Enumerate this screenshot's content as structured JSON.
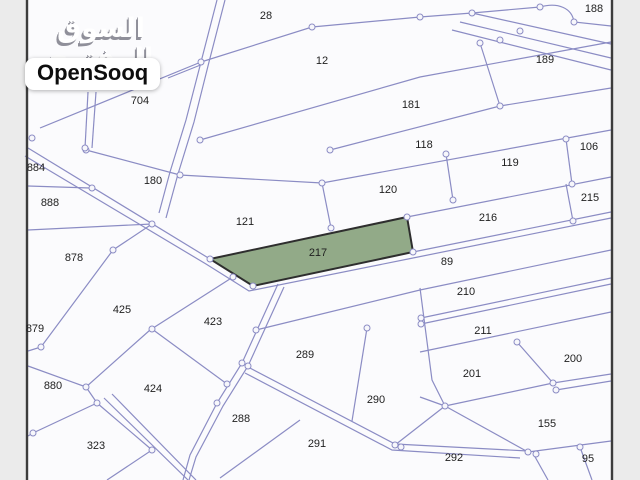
{
  "branding": {
    "arabic_logo": "السوق المفتوح",
    "latin_logo": "OpenSooq"
  },
  "map": {
    "type": "cadastral-parcel-map",
    "highlighted_parcel": {
      "number": "217",
      "fill": "#92aa88",
      "polygon": "210,259 407,217 413,252 253,286"
    },
    "colors": {
      "parcel_line": "#8b8cc4",
      "map_border": "#3c3c3c",
      "map_background": "#fbfbfd",
      "margin": "#ebebeb",
      "label_text": "#1f1f1f",
      "highlight_green": "#92aa88"
    },
    "parcels": [
      {
        "number": "28",
        "x": 266,
        "y": 16
      },
      {
        "number": "12",
        "x": 322,
        "y": 61
      },
      {
        "number": "188",
        "x": 594,
        "y": 9
      },
      {
        "number": "189",
        "x": 545,
        "y": 60
      },
      {
        "number": "704",
        "x": 140,
        "y": 101
      },
      {
        "number": "181",
        "x": 411,
        "y": 105
      },
      {
        "number": "118",
        "x": 424,
        "y": 145
      },
      {
        "number": "106",
        "x": 589,
        "y": 147
      },
      {
        "number": "119",
        "x": 510,
        "y": 163
      },
      {
        "number": "884",
        "x": 36,
        "y": 168
      },
      {
        "number": "180",
        "x": 153,
        "y": 181
      },
      {
        "number": "120",
        "x": 388,
        "y": 190
      },
      {
        "number": "215",
        "x": 590,
        "y": 198
      },
      {
        "number": "888",
        "x": 50,
        "y": 203
      },
      {
        "number": "216",
        "x": 488,
        "y": 218
      },
      {
        "number": "121",
        "x": 245,
        "y": 222
      },
      {
        "number": "217",
        "x": 318,
        "y": 253
      },
      {
        "number": "878",
        "x": 74,
        "y": 258
      },
      {
        "number": "89",
        "x": 447,
        "y": 262
      },
      {
        "number": "210",
        "x": 466,
        "y": 292
      },
      {
        "number": "425",
        "x": 122,
        "y": 310
      },
      {
        "number": "423",
        "x": 213,
        "y": 322
      },
      {
        "number": "879",
        "x": 35,
        "y": 329
      },
      {
        "number": "211",
        "x": 483,
        "y": 331
      },
      {
        "number": "289",
        "x": 305,
        "y": 355
      },
      {
        "number": "200",
        "x": 573,
        "y": 359
      },
      {
        "number": "201",
        "x": 472,
        "y": 374
      },
      {
        "number": "880",
        "x": 53,
        "y": 386
      },
      {
        "number": "424",
        "x": 153,
        "y": 389
      },
      {
        "number": "290",
        "x": 376,
        "y": 400
      },
      {
        "number": "288",
        "x": 241,
        "y": 419
      },
      {
        "number": "155",
        "x": 547,
        "y": 424
      },
      {
        "number": "291",
        "x": 317,
        "y": 444
      },
      {
        "number": "323",
        "x": 96,
        "y": 446
      },
      {
        "number": "292",
        "x": 454,
        "y": 458
      },
      {
        "number": "95",
        "x": 588,
        "y": 459
      }
    ]
  }
}
